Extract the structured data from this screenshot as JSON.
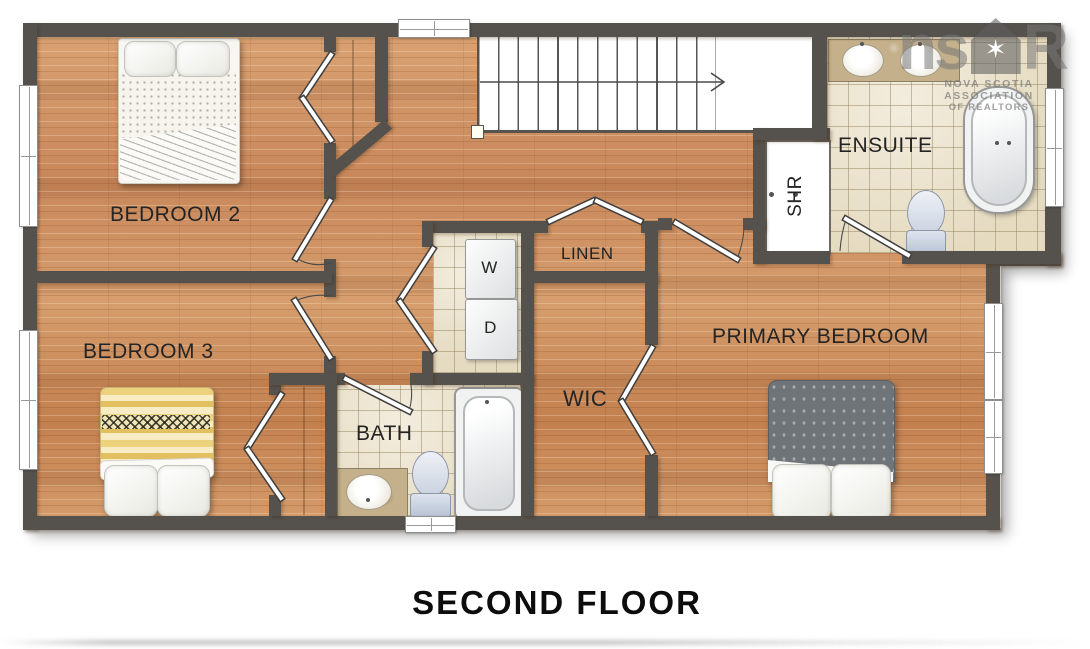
{
  "title": "SECOND FLOOR",
  "rooms": {
    "bedroom2": "BEDROOM 2",
    "bedroom3": "BEDROOM 3",
    "primary_bedroom": "PRIMARY BEDROOM",
    "ensuite": "ENSUITE",
    "bath": "BATH",
    "wic": "WIC",
    "linen": "LINEN",
    "shower": "SHR",
    "washer": "W",
    "dryer": "D"
  },
  "watermark": {
    "prefix": "ns",
    "suffix": "R",
    "star": "✶",
    "line1": "NOVA SCOTIA ASSOCIATION",
    "line2": "OF REALTORS"
  },
  "colors": {
    "wall": "#55524d",
    "wood_floor": "#cf9565",
    "tile_floor": "#ebe3cf",
    "bed_yellow": "#ecd27c",
    "bed_gray": "#6f7478",
    "fixture_blue": "#c9d2e0"
  }
}
